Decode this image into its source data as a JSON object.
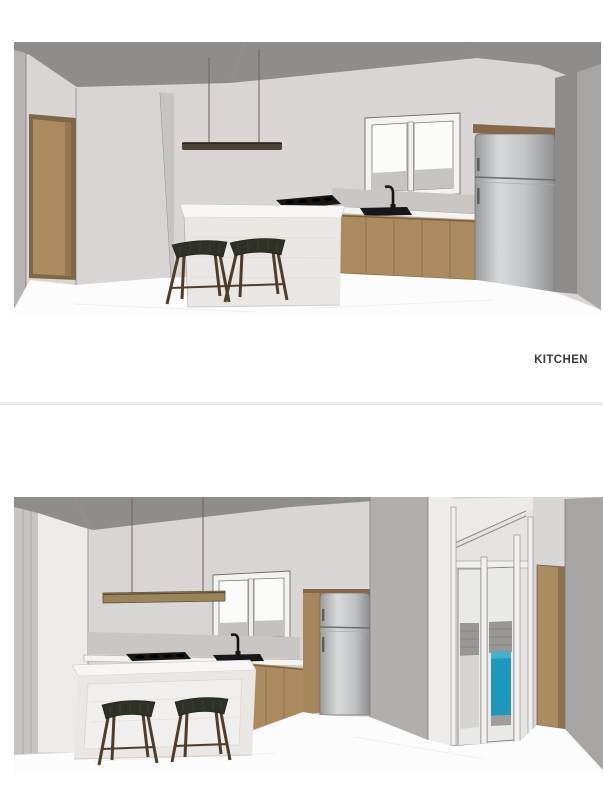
{
  "page": {
    "background": "#ffffff"
  },
  "kitchen_label": {
    "text": "KITCHEN",
    "color": "#3b3b3b"
  },
  "divider": {
    "color": "#eceae9"
  },
  "renders": {
    "top": {
      "alt": "Kitchen 3D render, view 1: white island with two dark saddle bar stools, gas cooktop, black sink and faucet below a two-pane window, timber base cabinets, stainless refrigerator and timber entry door",
      "objects": [
        "entry-door",
        "partition-wall",
        "pendant-light",
        "window",
        "backsplash",
        "countertop",
        "gas-cooktop",
        "sink",
        "faucet",
        "timber-base-cabinets",
        "kitchen-island",
        "bar-stool-left",
        "bar-stool-right",
        "refrigerator",
        "ceiling",
        "floor"
      ]
    },
    "bottom": {
      "alt": "Kitchen 3D render, view 2: same kitchen seen from the opposite corner with pendant light, window, island with two stools, tall timber cabinet, refrigerator, glass door with blue panel beyond and timber side door",
      "objects": [
        "pendant-light",
        "window",
        "backsplash",
        "countertop",
        "gas-cooktop",
        "sink",
        "faucet",
        "kitchen-island",
        "bar-stool-left",
        "bar-stool-right",
        "timber-base-cabinets",
        "tall-timber-cabinet",
        "refrigerator",
        "hallway-wall",
        "glass-door",
        "blue-panel",
        "timber-side-door",
        "ceiling",
        "floor"
      ]
    }
  },
  "colors": {
    "page_bg": "#ffffff",
    "label": "#3b3b3b",
    "divider": "#eceae9",
    "wall": "#d8d5d4",
    "wall_light": "#ecebea",
    "ceiling": "#8f8d8c",
    "side_wall": "#a7a5a4",
    "strip_wall": "#b6b3b2",
    "wood": "#ab8a5f",
    "wood_dark": "#8a6b47",
    "counter": "#f4f3f1",
    "backsplash": "#c8c5c3",
    "island_face": "#e9e6e4",
    "stool_seat": "#2e3127",
    "stool_leg": "#4f3c2b",
    "appliance_black": "#161614",
    "stainless": "#c6c7c8",
    "accent_blue": "#1d97bc",
    "floor": "#fcfcfc"
  }
}
